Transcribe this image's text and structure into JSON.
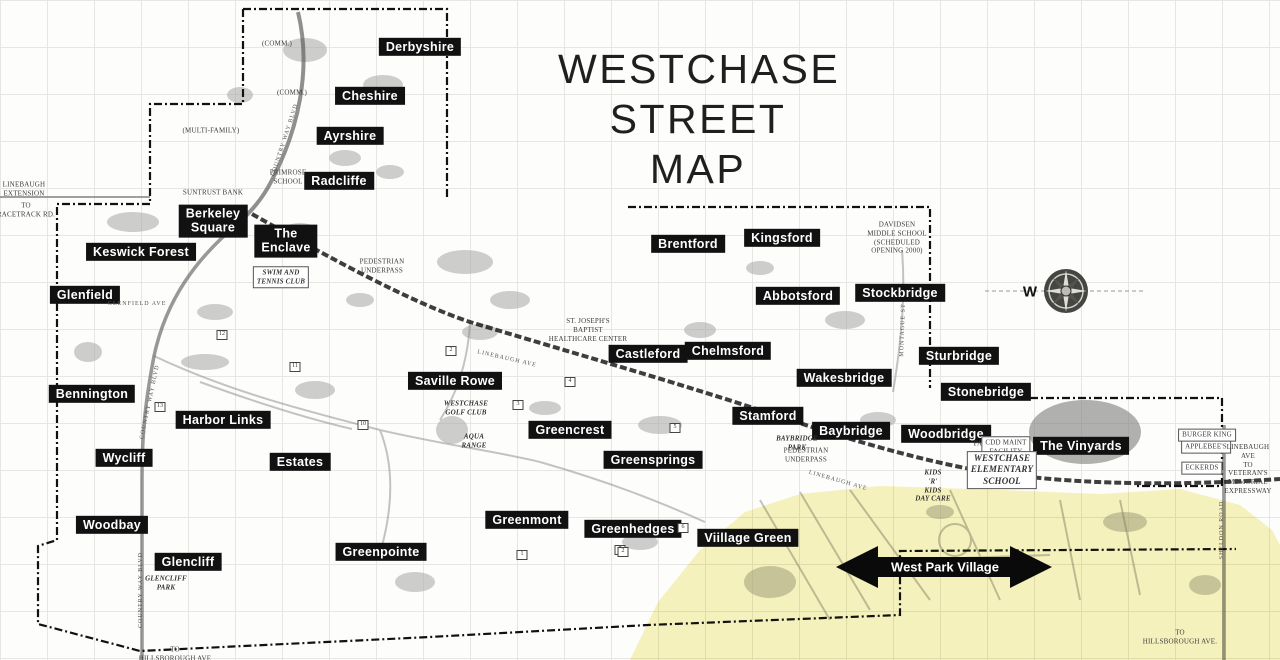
{
  "map": {
    "title": {
      "line1": "WESTCHASE",
      "line2": "STREET MAP"
    },
    "compass": {
      "letter": "W"
    },
    "arrow": {
      "label": "West Park Village"
    },
    "colors": {
      "highlight_yellow": "#f0e98c",
      "label_background": "#111111",
      "label_text": "#ffffff",
      "map_line": "#2a2a2a",
      "grid": "#e7e6e2"
    },
    "place_labels": [
      {
        "id": "derbyshire",
        "text": "Derbyshire",
        "x": 420,
        "y": 47
      },
      {
        "id": "cheshire",
        "text": "Cheshire",
        "x": 370,
        "y": 96
      },
      {
        "id": "ayrshire",
        "text": "Ayrshire",
        "x": 350,
        "y": 136
      },
      {
        "id": "radcliffe",
        "text": "Radcliffe",
        "x": 339,
        "y": 181
      },
      {
        "id": "berkeley-square",
        "text": "Berkeley\nSquare",
        "x": 213,
        "y": 221
      },
      {
        "id": "the-enclave",
        "text": "The\nEnclave",
        "x": 286,
        "y": 241
      },
      {
        "id": "keswick-forest",
        "text": "Keswick Forest",
        "x": 141,
        "y": 252
      },
      {
        "id": "glenfield",
        "text": "Glenfield",
        "x": 85,
        "y": 295
      },
      {
        "id": "bennington",
        "text": "Bennington",
        "x": 92,
        "y": 394
      },
      {
        "id": "harbor-links",
        "text": "Harbor Links",
        "x": 223,
        "y": 420
      },
      {
        "id": "wycliff",
        "text": "Wycliff",
        "x": 124,
        "y": 458
      },
      {
        "id": "estates",
        "text": "Estates",
        "x": 300,
        "y": 462
      },
      {
        "id": "woodbay",
        "text": "Woodbay",
        "x": 112,
        "y": 525
      },
      {
        "id": "glencliff",
        "text": "Glencliff",
        "x": 188,
        "y": 562
      },
      {
        "id": "saville-rowe",
        "text": "Saville Rowe",
        "x": 455,
        "y": 381
      },
      {
        "id": "greencrest",
        "text": "Greencrest",
        "x": 570,
        "y": 430
      },
      {
        "id": "greensprings",
        "text": "Greensprings",
        "x": 653,
        "y": 460
      },
      {
        "id": "greenmont",
        "text": "Greenmont",
        "x": 527,
        "y": 520
      },
      {
        "id": "greenhedges",
        "text": "Greenhedges",
        "x": 633,
        "y": 529
      },
      {
        "id": "greenpointe",
        "text": "Greenpointe",
        "x": 381,
        "y": 552
      },
      {
        "id": "village-green",
        "text": "Viillage Green",
        "x": 748,
        "y": 538
      },
      {
        "id": "brentford",
        "text": "Brentford",
        "x": 688,
        "y": 244
      },
      {
        "id": "kingsford",
        "text": "Kingsford",
        "x": 782,
        "y": 238
      },
      {
        "id": "abbotsford",
        "text": "Abbotsford",
        "x": 798,
        "y": 296
      },
      {
        "id": "stockbridge",
        "text": "Stockbridge",
        "x": 900,
        "y": 293
      },
      {
        "id": "castleford",
        "text": "Castleford",
        "x": 648,
        "y": 354
      },
      {
        "id": "chelmsford",
        "text": "Chelmsford",
        "x": 728,
        "y": 351
      },
      {
        "id": "sturbridge",
        "text": "Sturbridge",
        "x": 959,
        "y": 356
      },
      {
        "id": "wakesbridge",
        "text": "Wakesbridge",
        "x": 844,
        "y": 378
      },
      {
        "id": "stamford",
        "text": "Stamford",
        "x": 768,
        "y": 416
      },
      {
        "id": "baybridge",
        "text": "Baybridge",
        "x": 851,
        "y": 431
      },
      {
        "id": "stonebridge",
        "text": "Stonebridge",
        "x": 986,
        "y": 392
      },
      {
        "id": "woodbridge",
        "text": "Woodbridge",
        "x": 946,
        "y": 434
      },
      {
        "id": "the-vinyards",
        "text": "The Vinyards",
        "x": 1081,
        "y": 446
      }
    ],
    "small_labels": [
      {
        "id": "comm-1",
        "text": "(COMM.)",
        "x": 277,
        "y": 44,
        "kind": "plain"
      },
      {
        "id": "comm-2",
        "text": "(COMM.)",
        "x": 292,
        "y": 93,
        "kind": "plain"
      },
      {
        "id": "multi-family",
        "text": "(MULTI-FAMILY)",
        "x": 211,
        "y": 131,
        "kind": "plain"
      },
      {
        "id": "linebaugh-extension",
        "text": "LINEBAUGH\nEXTENSION",
        "x": 24,
        "y": 189,
        "kind": "plain"
      },
      {
        "id": "to-racetrack-rd",
        "text": "TO\nRACETRACK RD.",
        "x": 26,
        "y": 210,
        "kind": "plain"
      },
      {
        "id": "suntrust-bank",
        "text": "SUNTRUST BANK",
        "x": 213,
        "y": 193,
        "kind": "plain"
      },
      {
        "id": "primrose-school",
        "text": "PRIMROSE\nSCHOOL",
        "x": 288,
        "y": 177,
        "kind": "plain"
      },
      {
        "id": "swim-tennis-club",
        "text": "SWIM AND\nTENNIS CLUB",
        "x": 281,
        "y": 277,
        "kind": "italic boxed"
      },
      {
        "id": "st-josephs",
        "text": "ST. JOSEPH'S\nBAPTIST\nHEALTHCARE CENTER",
        "x": 588,
        "y": 330,
        "kind": "plain"
      },
      {
        "id": "westchase-golf-club",
        "text": "WESTCHASE\nGOLF  CLUB",
        "x": 466,
        "y": 408,
        "kind": "italic"
      },
      {
        "id": "aqua-range",
        "text": "AQUA\nRANGE",
        "x": 474,
        "y": 441,
        "kind": "italic"
      },
      {
        "id": "davidsen-middle-school",
        "text": "DAVIDSEN\nMIDDLE SCHOOL\n(SCHEDULED\nOPENING 2000)",
        "x": 897,
        "y": 238,
        "kind": "plain"
      },
      {
        "id": "baybridge-park",
        "text": "BAYBRIDGE\nPARK",
        "x": 797,
        "y": 443,
        "kind": "italic"
      },
      {
        "id": "pedestrian-underpass-1",
        "text": "PEDESTRIAN\nUNDERPASS",
        "x": 382,
        "y": 266,
        "kind": "plain"
      },
      {
        "id": "pedestrian-underpass-2",
        "text": "PEDESTRIAN\nUNDERPASS",
        "x": 806,
        "y": 455,
        "kind": "plain"
      },
      {
        "id": "park",
        "text": "PARK",
        "x": 983,
        "y": 444,
        "kind": "plain"
      },
      {
        "id": "cdd-maint-facility",
        "text": "CDD MAINT\nFACILITY",
        "x": 1006,
        "y": 447,
        "kind": "plain boxed"
      },
      {
        "id": "westchase-elementary",
        "text": "WESTCHASE\nELEMENTARY\nSCHOOL",
        "x": 1002,
        "y": 470,
        "kind": "italic boxed big"
      },
      {
        "id": "kids-r-kids",
        "text": "KIDS\n'R'\nKIDS\nDAY CARE",
        "x": 933,
        "y": 486,
        "kind": "italic"
      },
      {
        "id": "burger-king",
        "text": "BURGER KING",
        "x": 1207,
        "y": 435,
        "kind": "plain boxed"
      },
      {
        "id": "applebees",
        "text": "APPLEBEE'S",
        "x": 1206,
        "y": 447,
        "kind": "plain boxed"
      },
      {
        "id": "eckerds",
        "text": "ECKERDS",
        "x": 1202,
        "y": 468,
        "kind": "plain boxed"
      },
      {
        "id": "linebaugh-to-veterans",
        "text": "LINEBAUGH AVE\nTO VETERAN'S\nMEMORIAL\nEXPRESSWAY",
        "x": 1248,
        "y": 469,
        "kind": "plain"
      },
      {
        "id": "glencliff-park",
        "text": "GLENCLIFF\nPARK",
        "x": 166,
        "y": 583,
        "kind": "italic"
      },
      {
        "id": "to-hillsborough-sw",
        "text": "TO\nHILLSBOROUGH AVE",
        "x": 175,
        "y": 654,
        "kind": "plain"
      },
      {
        "id": "to-hillsborough-se",
        "text": "TO\nHILLSBOROUGH AVE.",
        "x": 1180,
        "y": 637,
        "kind": "plain"
      }
    ],
    "road_labels": [
      {
        "id": "country-way-blvd-n",
        "text": "COUNTRY WAY BLVD",
        "x": 285,
        "y": 140,
        "rotate": -72
      },
      {
        "id": "linebaugh-ave-1",
        "text": "LINEBAUGH  AVE",
        "x": 507,
        "y": 359,
        "rotate": 13
      },
      {
        "id": "linebaugh-ave-2",
        "text": "LINEBAUGH AVE",
        "x": 838,
        "y": 481,
        "rotate": 16
      },
      {
        "id": "glenfield-ave",
        "text": "GLENFIELD\nAVE",
        "x": 137,
        "y": 304,
        "rotate": 0
      },
      {
        "id": "country-way-blvd-mid",
        "text": "COUNTRY WAY BLVD",
        "x": 150,
        "y": 402,
        "rotate": -78
      },
      {
        "id": "country-way-blvd-s",
        "text": "COUNTRY WAY BLVD",
        "x": 141,
        "y": 590,
        "rotate": -90
      },
      {
        "id": "montague-st",
        "text": "MONTAGUE ST",
        "x": 903,
        "y": 330,
        "rotate": -88
      },
      {
        "id": "sheldon-road",
        "text": "SHELDON ROAD",
        "x": 1222,
        "y": 530,
        "rotate": -90
      }
    ],
    "hole_markers": [
      {
        "n": "12",
        "x": 222,
        "y": 335
      },
      {
        "n": "11",
        "x": 295,
        "y": 367
      },
      {
        "n": "13",
        "x": 160,
        "y": 407
      },
      {
        "n": "10",
        "x": 363,
        "y": 425
      },
      {
        "n": "2",
        "x": 451,
        "y": 351
      },
      {
        "n": "4",
        "x": 570,
        "y": 382
      },
      {
        "n": "3",
        "x": 518,
        "y": 405
      },
      {
        "n": "5",
        "x": 675,
        "y": 428
      },
      {
        "n": "6",
        "x": 683,
        "y": 528
      },
      {
        "n": "7",
        "x": 620,
        "y": 550
      },
      {
        "n": "1",
        "x": 522,
        "y": 555
      },
      {
        "n": "2",
        "x": 623,
        "y": 552
      }
    ]
  }
}
